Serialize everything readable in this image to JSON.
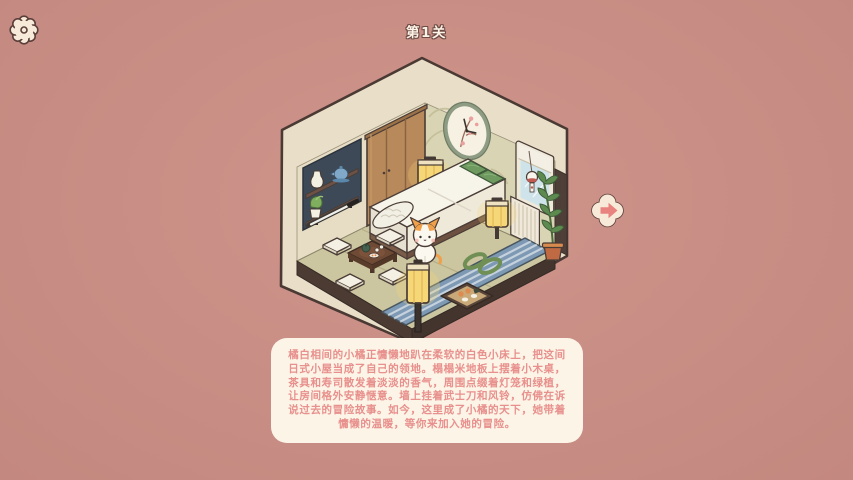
{
  "header": {
    "level_label": "第1关"
  },
  "story": {
    "text": "橘白相间的小橘正慵懒地趴在柔软的白色小床上，把这间日式小屋当成了自己的领地。榻榻米地板上摆着小木桌，茶具和寿司散发着淡淡的香气，周围点缀着灯笼和绿植，让房间格外安静惬意。墙上挂着武士刀和风铃，仿佛在诉说过去的冒险故事。如今，这里成了小橘的天下，她带着慵懒的温暖，等你来加入她的冒险。"
  },
  "icons": {
    "settings": "gear-icon",
    "next": "arrow-right-icon"
  },
  "colors": {
    "background": "#c88e85",
    "panel_bg": "#fcf4e6",
    "story_text": "#e8908d",
    "arrow_accent": "#e8837f",
    "outline": "#4a3c36",
    "tatami": "#cbc5a0",
    "lantern_glow": "#f6d778"
  },
  "room": {
    "items": [
      "wardrobe",
      "wall-clock",
      "window",
      "wind-chime",
      "shelf-unit",
      "vase",
      "teapot",
      "potted-plant",
      "katana",
      "bed",
      "green-pillows",
      "calico-cat",
      "paper-lantern-left",
      "paper-lantern-right",
      "floor-lantern",
      "tea-table",
      "tea-set",
      "floor-cushions",
      "blue-rug",
      "sushi-tray",
      "rope-rings",
      "bamboo-plant"
    ]
  }
}
